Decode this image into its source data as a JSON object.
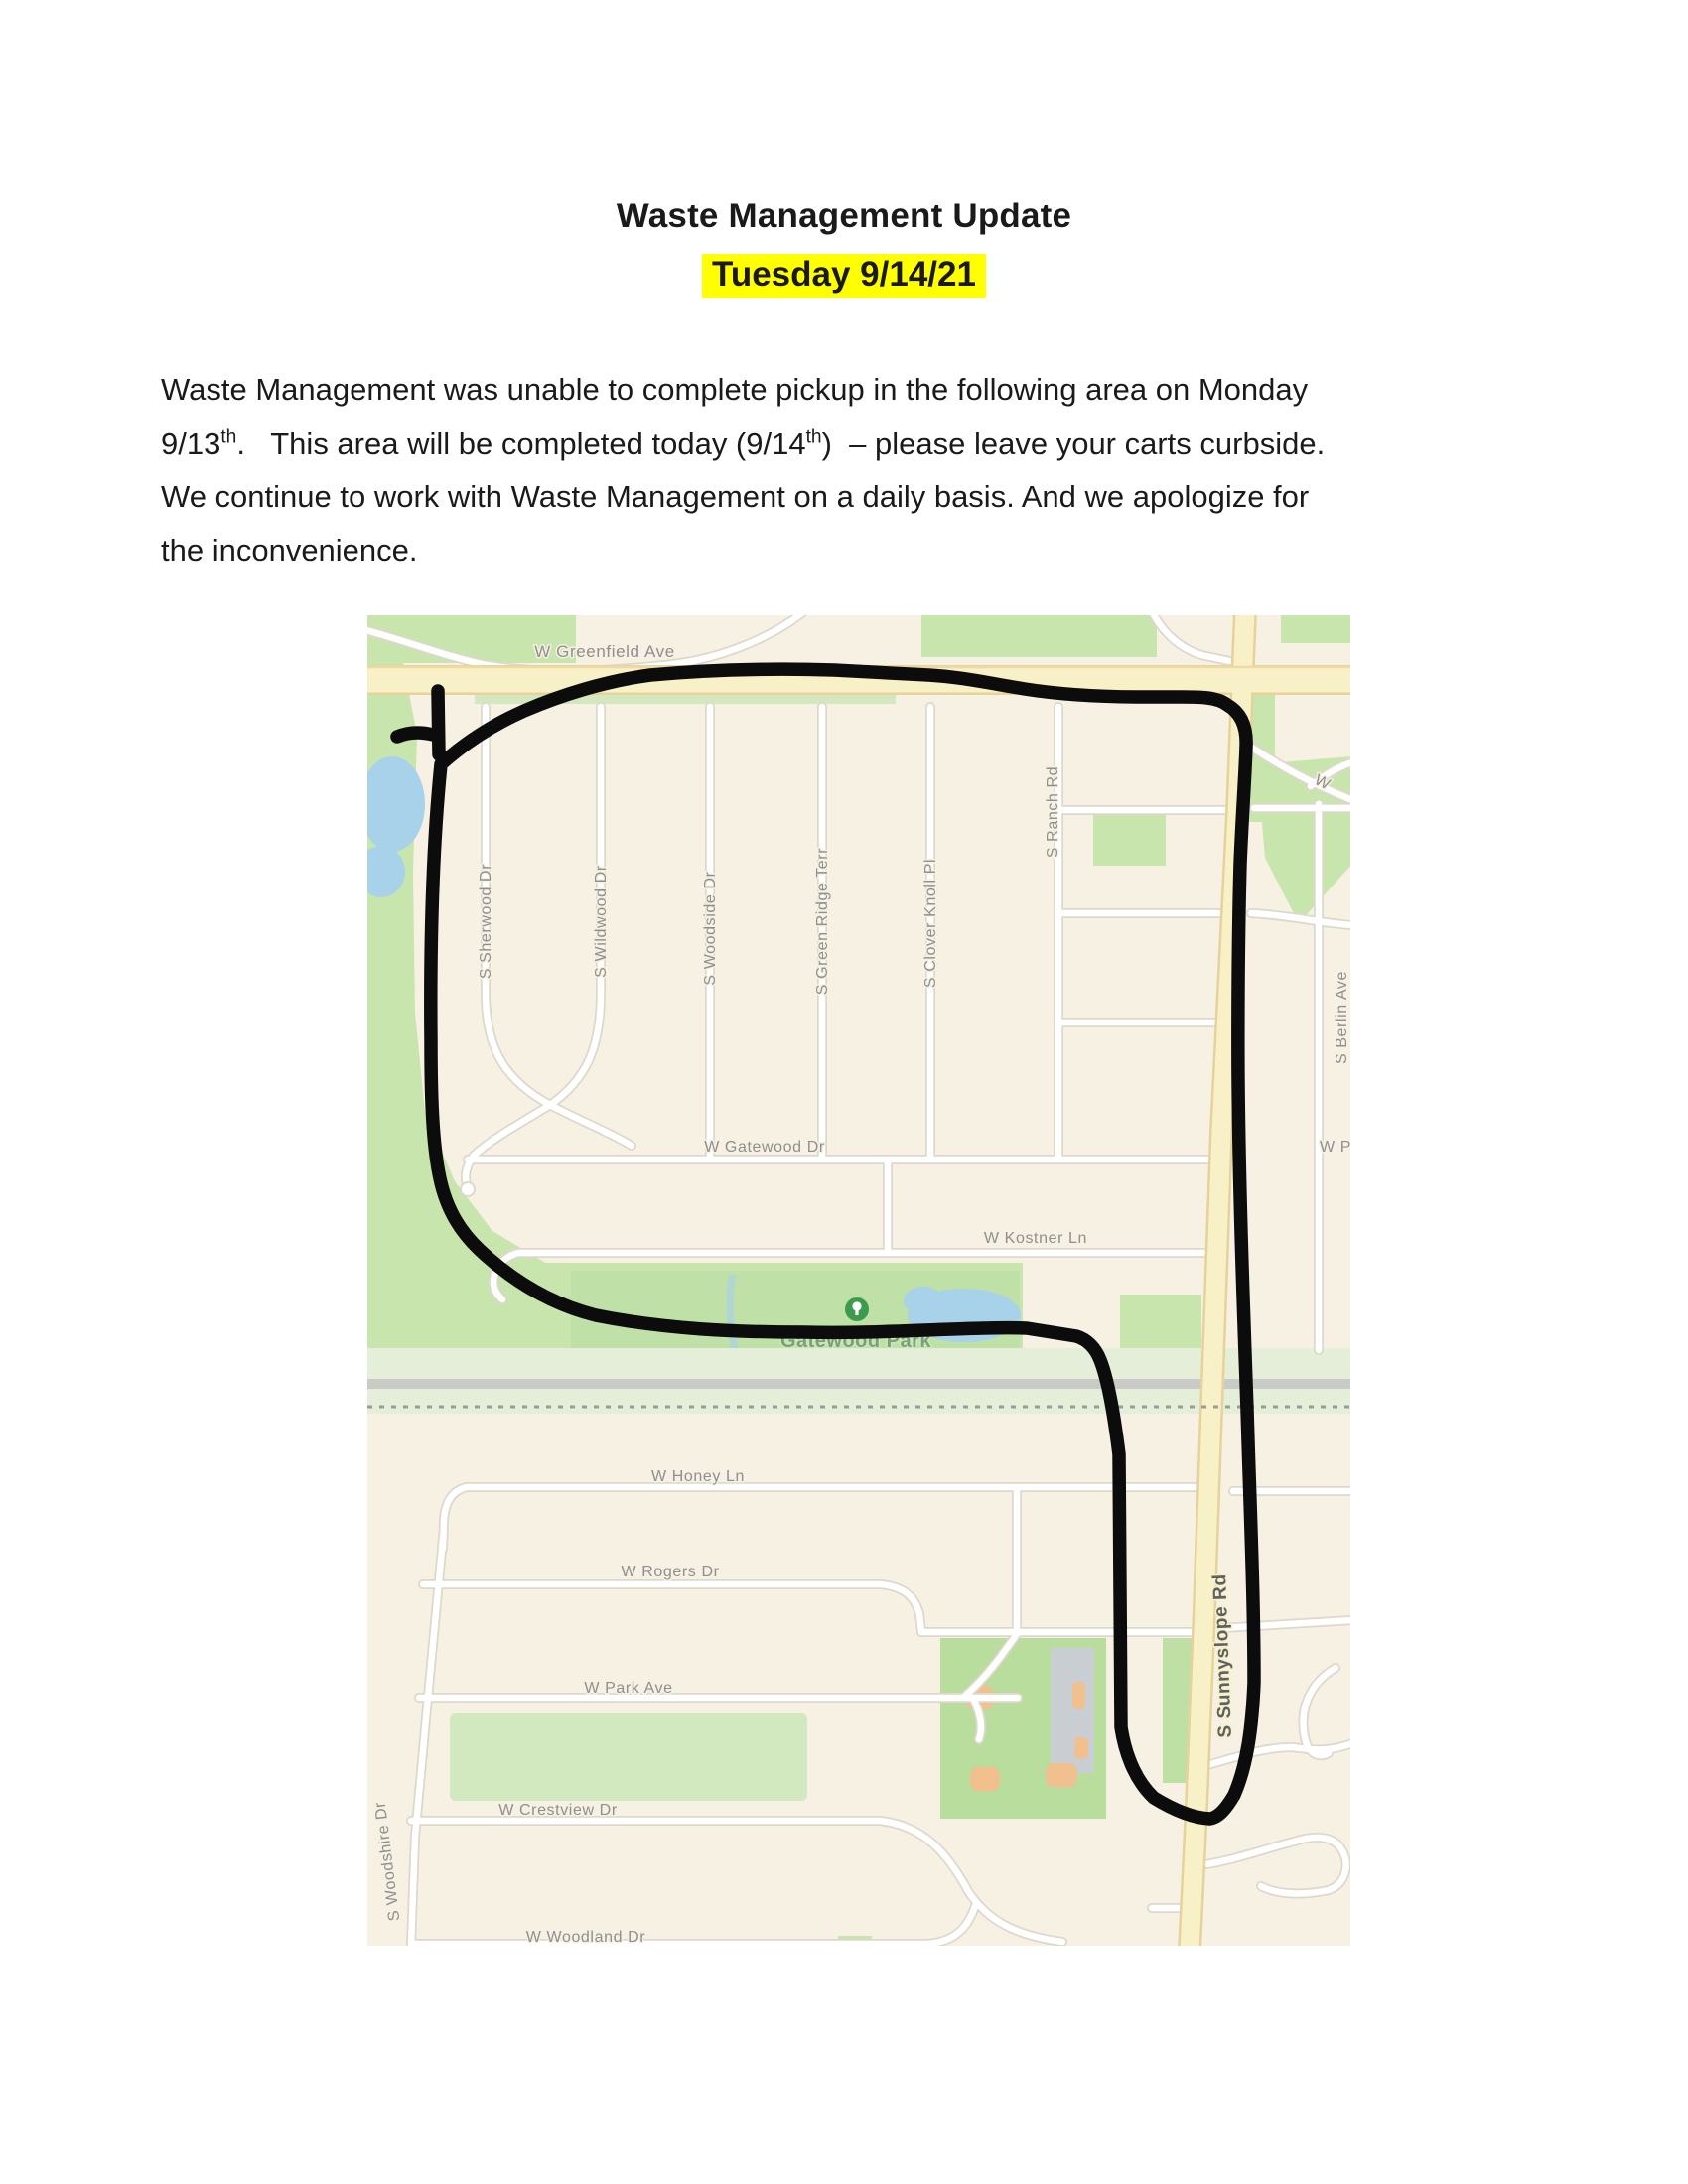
{
  "page": {
    "title": "Waste Management Update",
    "subtitle": "Tuesday 9/14/21",
    "highlight_color": "#ffff00"
  },
  "paragraph": {
    "lines": [
      [
        {
          "t": "Waste Management was unable to complete pickup in the following area on Monday"
        }
      ],
      [
        {
          "t": "9/13"
        },
        {
          "sup": "th"
        },
        {
          "t": ".   This area will be completed today (9/14"
        },
        {
          "sup": "th"
        },
        {
          "t": ")  – please leave your carts curbside."
        }
      ],
      [
        {
          "t": "We continue to work with Waste Management on a daily basis. And we apologize for"
        }
      ],
      [
        {
          "t": "the inconvenience."
        }
      ]
    ]
  },
  "map": {
    "description": "street map with hand-drawn pickup area outline",
    "colors": {
      "background": "#f6f1e3",
      "green": "#c9e5ae",
      "park_green": "#bfe0a6",
      "rail_band": "#e4eed8",
      "pond_blue": "#a8d2ea",
      "road_yellow": "#f8f0c6",
      "outline_black": "#0c0c0c"
    },
    "labels": [
      {
        "text": "W Greenfield Ave"
      },
      {
        "text": "S Sherwood Dr"
      },
      {
        "text": "S Wildwood Dr"
      },
      {
        "text": "S Woodside Dr"
      },
      {
        "text": "S Green Ridge Terr"
      },
      {
        "text": "S Clover Knoll Pl"
      },
      {
        "text": "S Ranch Rd"
      },
      {
        "text": "S Berlin Ave"
      },
      {
        "text": "W Gatewood Dr"
      },
      {
        "text": "W Kostner Ln"
      },
      {
        "text": "Gatewood Park"
      },
      {
        "text": "W Honey Ln"
      },
      {
        "text": "W Rogers Dr"
      },
      {
        "text": "W Park Ave"
      },
      {
        "text": "W Crestview Dr"
      },
      {
        "text": "W Woodland Dr"
      },
      {
        "text": "S Woodshire Dr"
      },
      {
        "text": "S Sunnyslope Rd"
      },
      {
        "text": "W"
      },
      {
        "text": "W P"
      }
    ]
  }
}
